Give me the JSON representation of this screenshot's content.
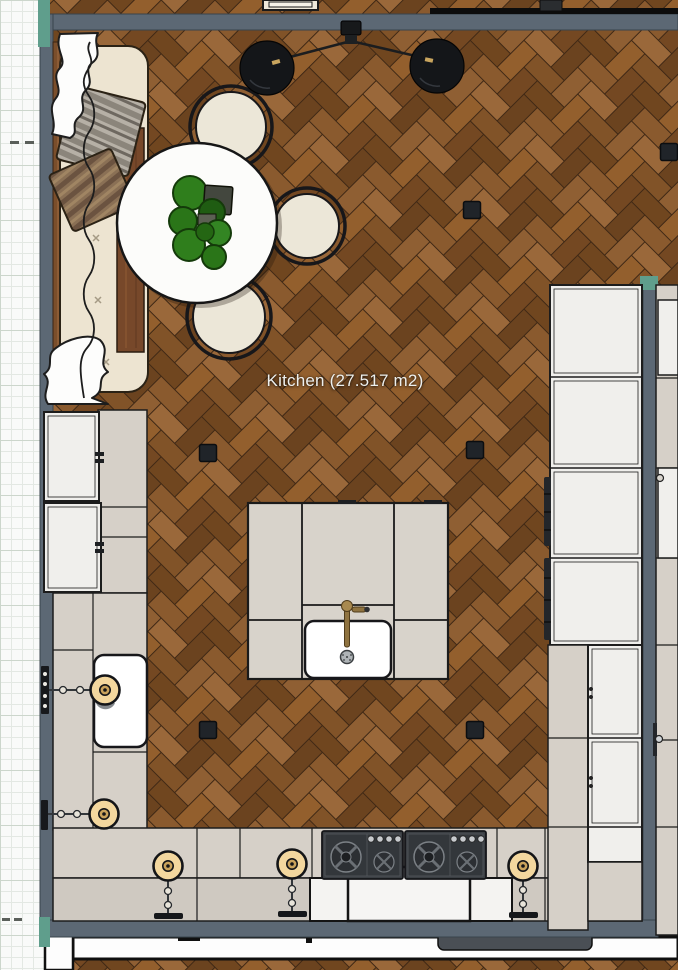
{
  "room": {
    "label": "Kitchen (27.517 m2)",
    "name": "Kitchen",
    "area_m2": "27.517"
  },
  "palette": {
    "wall": "#5c6874",
    "floor_dark": "#6b431f",
    "floor_light": "#9a683a",
    "cabinet_beige": "#d6d0c8",
    "counter": "#cfc9c1",
    "cabinet_white": "#f0efec",
    "accent_teal": "#5f9e8c",
    "lamp_shade": "#f3d79e",
    "brass": "#c9a25b",
    "plant_green": "#2f7e1c",
    "paper": "#f9faf9"
  },
  "fixtures": {
    "ceiling_pendant_shades": 2,
    "floor_spotlights": 6,
    "wall_lamps": 5,
    "cooktop_units": 2,
    "sinks": 2,
    "dining_chairs": 3
  }
}
